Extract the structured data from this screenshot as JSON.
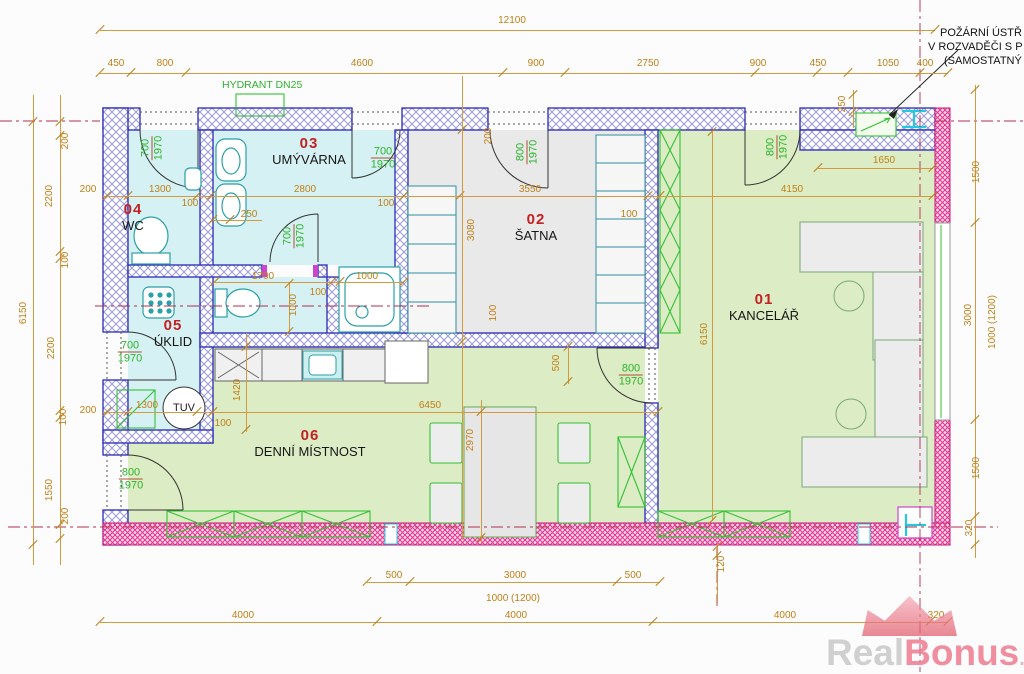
{
  "note": {
    "lines": [
      "POŽÁRNÍ ÚSTŘ",
      "V ROZVADĚČI S P",
      "(SAMOSTATNÝ"
    ]
  },
  "hydrant_label": "HYDRANT DN25",
  "tuv_label": "TUV",
  "watermark": {
    "gray": "Real",
    "pink": "Bonus",
    "suffix": ".cz"
  },
  "colors": {
    "dimension": "#c08018",
    "door_label_green": "#2db42d",
    "room_number_red": "#c32222",
    "wall_blue": "#2b2bb5",
    "wall_pink": "#e03a90",
    "room_cyan": "#d6f1f3",
    "room_green": "#dcecc4",
    "room_gray": "#e9e9e9",
    "axis_red": "#b03050"
  },
  "plan": {
    "rooms": [
      {
        "num": "01",
        "name": "KANCELÁŘ",
        "x": 764,
        "y": 292
      },
      {
        "num": "02",
        "name": "ŠATNA",
        "x": 536,
        "y": 212
      },
      {
        "num": "03",
        "name": "UMÝVÁRNA",
        "x": 309,
        "y": 136
      },
      {
        "num": "04",
        "name": "WC",
        "x": 133,
        "y": 202
      },
      {
        "num": "05",
        "name": "ÚKLID",
        "x": 173,
        "y": 318
      },
      {
        "num": "06",
        "name": "DENNÍ MÍSTNOST",
        "x": 310,
        "y": 428
      }
    ],
    "doors": [
      {
        "a": "700",
        "b": "1970",
        "x": 152,
        "y": 148,
        "v": true
      },
      {
        "a": "700",
        "b": "1970",
        "x": 383,
        "y": 158,
        "v": false
      },
      {
        "a": "800",
        "b": "1970",
        "x": 527,
        "y": 152,
        "v": true
      },
      {
        "a": "800",
        "b": "1970",
        "x": 777,
        "y": 147,
        "v": true
      },
      {
        "a": "700",
        "b": "1970",
        "x": 294,
        "y": 236,
        "v": true
      },
      {
        "a": "700",
        "b": "1970",
        "x": 130,
        "y": 352,
        "v": false
      },
      {
        "a": "800",
        "b": "1970",
        "x": 131,
        "y": 479,
        "v": false
      },
      {
        "a": "800",
        "b": "1970",
        "x": 631,
        "y": 375,
        "v": false
      }
    ],
    "dims": [
      {
        "t": "12100",
        "x": 512,
        "y": 21
      },
      {
        "t": "450",
        "x": 116,
        "y": 64
      },
      {
        "t": "800",
        "x": 165,
        "y": 64
      },
      {
        "t": "4600",
        "x": 362,
        "y": 64
      },
      {
        "t": "900",
        "x": 536,
        "y": 64
      },
      {
        "t": "2750",
        "x": 648,
        "y": 64
      },
      {
        "t": "900",
        "x": 758,
        "y": 64
      },
      {
        "t": "450",
        "x": 818,
        "y": 64
      },
      {
        "t": "1050",
        "x": 888,
        "y": 64
      },
      {
        "t": "400",
        "x": 925,
        "y": 64
      },
      {
        "t": "250",
        "x": 843,
        "y": 104,
        "v": true
      },
      {
        "t": "6150",
        "x": 24,
        "y": 313,
        "v": true
      },
      {
        "t": "200",
        "x": 66,
        "y": 141,
        "v": true
      },
      {
        "t": "2200",
        "x": 50,
        "y": 196,
        "v": true
      },
      {
        "t": "100",
        "x": 66,
        "y": 260,
        "v": true
      },
      {
        "t": "2200",
        "x": 52,
        "y": 348,
        "v": true
      },
      {
        "t": "100",
        "x": 64,
        "y": 417,
        "v": true
      },
      {
        "t": "1550",
        "x": 50,
        "y": 490,
        "v": true
      },
      {
        "t": "200",
        "x": 66,
        "y": 516,
        "v": true
      },
      {
        "t": "200",
        "x": 88,
        "y": 190
      },
      {
        "t": "200",
        "x": 88,
        "y": 411
      },
      {
        "t": "1300",
        "x": 160,
        "y": 190
      },
      {
        "t": "100",
        "x": 190,
        "y": 204
      },
      {
        "t": "2800",
        "x": 305,
        "y": 190
      },
      {
        "t": "100",
        "x": 386,
        "y": 204
      },
      {
        "t": "250",
        "x": 249,
        "y": 215
      },
      {
        "t": "1700",
        "x": 263,
        "y": 277
      },
      {
        "t": "100",
        "x": 318,
        "y": 293
      },
      {
        "t": "1000",
        "x": 367,
        "y": 277
      },
      {
        "t": "1000",
        "x": 294,
        "y": 305,
        "v": true
      },
      {
        "t": "3550",
        "x": 530,
        "y": 190
      },
      {
        "t": "3080",
        "x": 472,
        "y": 230,
        "v": true
      },
      {
        "t": "200",
        "x": 489,
        "y": 136,
        "v": true
      },
      {
        "t": "100",
        "x": 629,
        "y": 215
      },
      {
        "t": "100",
        "x": 494,
        "y": 313,
        "v": true
      },
      {
        "t": "4150",
        "x": 792,
        "y": 190
      },
      {
        "t": "1650",
        "x": 884,
        "y": 161
      },
      {
        "t": "6150",
        "x": 705,
        "y": 334,
        "v": true
      },
      {
        "t": "500",
        "x": 557,
        "y": 363,
        "v": true
      },
      {
        "t": "1420",
        "x": 238,
        "y": 390,
        "v": true
      },
      {
        "t": "6450",
        "x": 430,
        "y": 406
      },
      {
        "t": "100",
        "x": 223,
        "y": 424
      },
      {
        "t": "1300",
        "x": 147,
        "y": 406
      },
      {
        "t": "2970",
        "x": 471,
        "y": 440,
        "v": true
      },
      {
        "t": "500",
        "x": 394,
        "y": 576
      },
      {
        "t": "3000",
        "x": 515,
        "y": 576
      },
      {
        "t": "1000  (1200)",
        "x": 513,
        "y": 599
      },
      {
        "t": "500",
        "x": 633,
        "y": 576
      },
      {
        "t": "4000",
        "x": 243,
        "y": 616
      },
      {
        "t": "4000",
        "x": 516,
        "y": 616
      },
      {
        "t": "4000",
        "x": 785,
        "y": 616
      },
      {
        "t": "320",
        "x": 936,
        "y": 616
      },
      {
        "t": "120",
        "x": 722,
        "y": 564,
        "v": true
      },
      {
        "t": "1500",
        "x": 977,
        "y": 172,
        "v": true
      },
      {
        "t": "3000",
        "x": 969,
        "y": 315,
        "v": true
      },
      {
        "t": "1000 (1200)",
        "x": 993,
        "y": 322,
        "v": true
      },
      {
        "t": "1500",
        "x": 977,
        "y": 468,
        "v": true
      },
      {
        "t": "320",
        "x": 970,
        "y": 528,
        "v": true
      }
    ],
    "hlines": [
      {
        "y": 30,
        "x1": 100,
        "x2": 935,
        "t": [
          100,
          935
        ]
      },
      {
        "y": 73,
        "x1": 100,
        "x2": 948,
        "t": [
          100,
          131,
          186,
          503,
          565,
          755,
          817,
          848,
          920,
          948
        ]
      },
      {
        "y": 196,
        "x1": 103,
        "x2": 933,
        "t": [
          107,
          128,
          197,
          211,
          404,
          460,
          648,
          660,
          933
        ]
      },
      {
        "y": 220,
        "x1": 213,
        "x2": 262,
        "t": [
          213,
          230
        ]
      },
      {
        "y": 282,
        "x1": 215,
        "x2": 404,
        "t": [
          215,
          332,
          340,
          404
        ]
      },
      {
        "y": 168,
        "x1": 818,
        "x2": 933,
        "t": [
          818,
          933
        ]
      },
      {
        "y": 412,
        "x1": 103,
        "x2": 658,
        "t": [
          107,
          128,
          197,
          213,
          658
        ]
      },
      {
        "y": 582,
        "x1": 367,
        "x2": 660,
        "t": [
          367,
          410,
          617,
          660
        ]
      },
      {
        "y": 622,
        "x1": 100,
        "x2": 948,
        "t": [
          100,
          377,
          653,
          930,
          948
        ]
      }
    ],
    "vlines": [
      {
        "x": 33,
        "y1": 95,
        "y2": 565,
        "t": [
          122,
          545
        ]
      },
      {
        "x": 60,
        "y1": 95,
        "y2": 565,
        "t": [
          122,
          136,
          252,
          259,
          411,
          418,
          525,
          539
        ]
      },
      {
        "x": 975,
        "y1": 85,
        "y2": 558,
        "t": [
          90,
          223,
          420,
          517,
          545
        ]
      },
      {
        "x": 853,
        "y1": 90,
        "y2": 128,
        "t": [
          95,
          112
        ]
      },
      {
        "x": 712,
        "y1": 132,
        "y2": 521,
        "t": [
          132,
          521
        ]
      },
      {
        "x": 462,
        "y1": 76,
        "y2": 540,
        "t": [
          130,
          342
        ]
      },
      {
        "x": 568,
        "y1": 347,
        "y2": 384,
        "t": [
          347,
          382
        ]
      },
      {
        "x": 289,
        "y1": 283,
        "y2": 333,
        "t": [
          284,
          332
        ]
      },
      {
        "x": 246,
        "y1": 333,
        "y2": 432,
        "t": [
          347,
          430
        ]
      },
      {
        "x": 481,
        "y1": 400,
        "y2": 543,
        "t": [
          412,
          538
        ]
      },
      {
        "x": 717,
        "y1": 545,
        "y2": 603,
        "t": [
          547,
          556
        ]
      }
    ]
  }
}
